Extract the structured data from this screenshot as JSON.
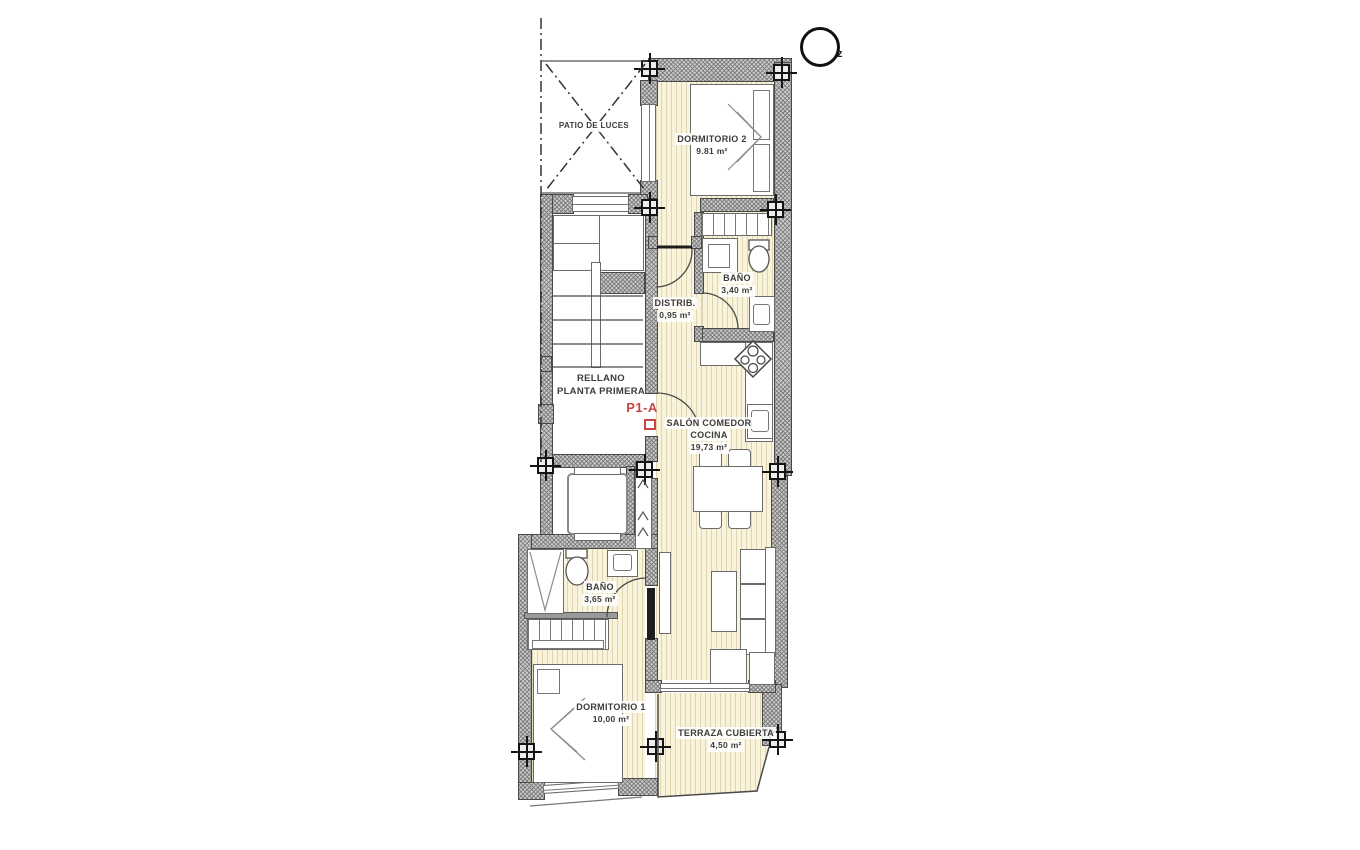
{
  "colors": {
    "room_fill": "#f8f3da",
    "wall_fill": "#cbcbcb",
    "line": "#4a4a4a",
    "accent_red": "#c94545"
  },
  "compass": {
    "label": "z"
  },
  "unit_label": "P1-A",
  "common_areas": {
    "patio": "PATIO DE LUCES",
    "landing_line1": "RELLANO",
    "landing_line2": "PLANTA PRIMERA"
  },
  "rooms": [
    {
      "name": "DORMITORIO 2",
      "area": "9.81 m²"
    },
    {
      "name": "BAÑO",
      "area": "3,40 m²"
    },
    {
      "name": "DISTRIB.",
      "area": "0,95 m²"
    },
    {
      "name": "SALÓN COMEDOR",
      "name2": "COCINA",
      "area": "19,73 m²"
    },
    {
      "name": "BAÑO",
      "area": "3,65 m²"
    },
    {
      "name": "DORMITORIO 1",
      "area": "10,00 m²"
    },
    {
      "name": "TERRAZA CUBIERTA",
      "area": "4,50 m²"
    }
  ]
}
